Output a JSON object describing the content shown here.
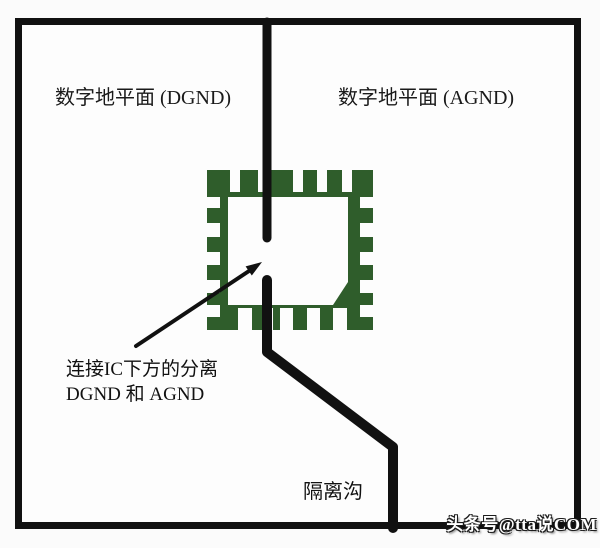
{
  "figure": {
    "left_plane": {
      "label": "数字地平面 (DGND)"
    },
    "right_plane": {
      "label": "数字地平面 (AGND)"
    },
    "annotation": {
      "line1": "连接IC下方的分离",
      "line2": "DGND 和 AGND"
    },
    "trench": {
      "label": "隔离沟"
    },
    "watermark": {
      "text": "头条号@tta说COM"
    },
    "colors": {
      "chip_green": "#2f5d2b",
      "line_black": "#111111",
      "board_bg": "#fdfdfd"
    }
  }
}
